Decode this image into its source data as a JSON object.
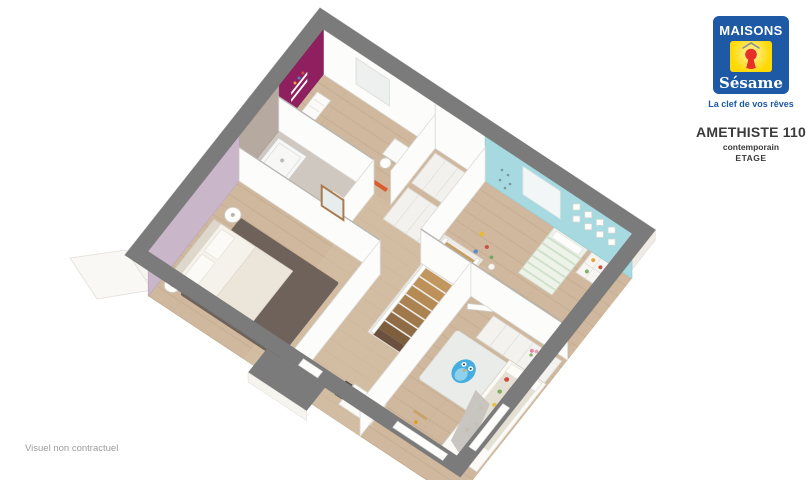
{
  "brand": {
    "name": "MAISONS",
    "wordmark": "Sésame",
    "tagline": "La clef de vos rêves"
  },
  "plan": {
    "title": "AMETHISTE 110",
    "style": "contemporain",
    "level": "ETAGE"
  },
  "footer": {
    "disclaimer": "Visuel non contractuel"
  },
  "colors": {
    "logo_blue": "#1d59a4",
    "logo_yellow": "#ffd903",
    "logo_red": "#e63128",
    "roof_gray": "#8a8f94",
    "wall_gray": "#7b7b7b",
    "wood_floor": "#cfb89e",
    "hall_floor": "#d6c1a8",
    "magenta_wall": "#8f1f5e",
    "turquoise_wall": "#a6d9e0",
    "mauve_wall": "#c9b6c9",
    "bathroom_wall": "#b5a9a0",
    "bathroom_floor": "#cfc8c0",
    "master_rug": "#6f625a",
    "kids_rug": "#e9ece8",
    "owl_blue": "#45aede",
    "stair_wood": "#c0965f",
    "text_dark": "#3a3a3a",
    "text_gray": "#9c9c9c"
  },
  "floorplan": {
    "view": "3d-axonometric-upper-floor",
    "rooms": [
      {
        "id": "bedroom-magenta",
        "accent": "#8f1f5e",
        "items": [
          "wall-shelf",
          "commode",
          "desk",
          "chair",
          "window"
        ]
      },
      {
        "id": "bedroom-turquoise",
        "accent": "#a6d9e0",
        "items": [
          "bed",
          "cubby-shelf",
          "picture-frames",
          "window",
          "toys"
        ]
      },
      {
        "id": "bathroom",
        "accent": "#b5a9a0",
        "items": [
          "shower",
          "vanity",
          "mirror"
        ]
      },
      {
        "id": "bedroom-master",
        "accent": "#c9b6c9",
        "items": [
          "double-bed",
          "nightstand",
          "nightstand",
          "rug"
        ]
      },
      {
        "id": "hallway",
        "accent": "#d6c1a8",
        "items": [
          "staircase",
          "railing",
          "dresser"
        ]
      },
      {
        "id": "bedroom-kids",
        "accent": "#e9ece8",
        "items": [
          "bed-floral",
          "canopy-drape",
          "owl-rug",
          "wardrobe",
          "toys",
          "door"
        ]
      }
    ]
  }
}
